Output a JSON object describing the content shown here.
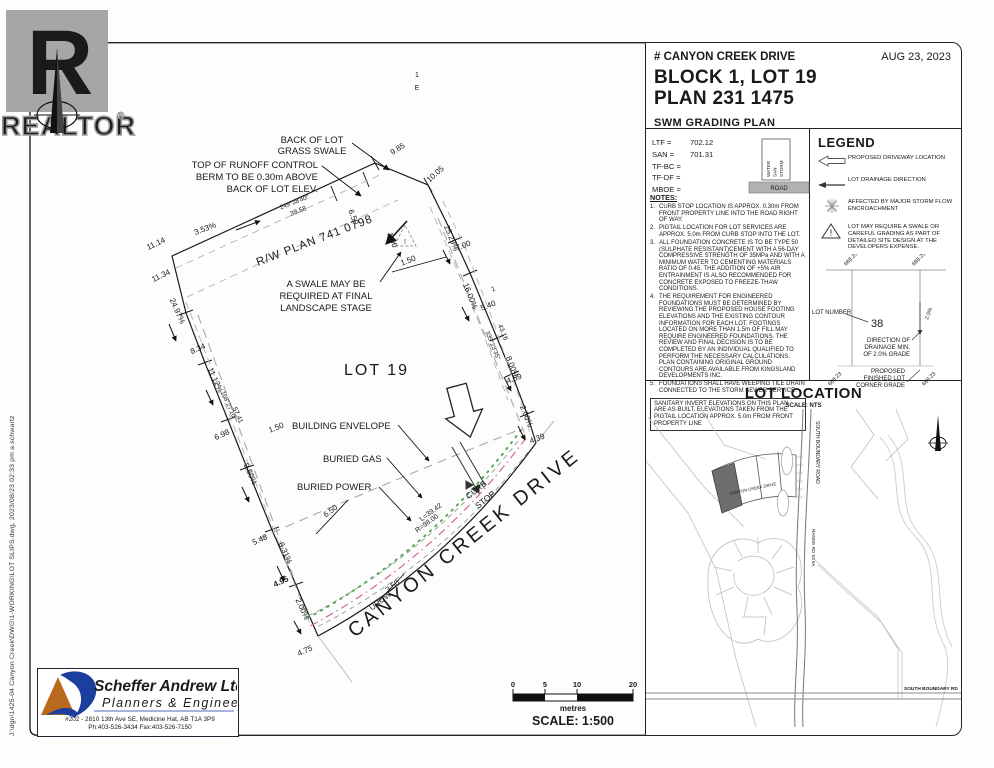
{
  "watermark": {
    "letter": "R",
    "brand": "REALTOR",
    "reg": "®"
  },
  "file_stamp": "J:\\dgn\\1425-04  Canyon Creek\\DWG\\1-WORKING\\LOT SLIPS.dwg,  2023/08/23 02:33 pm  a.schwartz",
  "title_block": {
    "street": "# CANYON CREEK DRIVE",
    "date": "AUG 23, 2023",
    "block_lot": "BLOCK 1, LOT 19",
    "plan": "PLAN 231 1475",
    "plan_type": "SWM GRADING PLAN",
    "elevations": [
      {
        "label": "LTF =",
        "value": "702.12"
      },
      {
        "label": "SAN =",
        "value": "701.31"
      },
      {
        "label": "TF-BC =",
        "value": ""
      },
      {
        "label": "TF-DF =",
        "value": ""
      },
      {
        "label": "MBOE =",
        "value": ""
      }
    ],
    "road_symbol": {
      "services": [
        "WATER",
        "SAN",
        "STORM"
      ],
      "road": "ROAD"
    }
  },
  "legend": {
    "title": "LEGEND",
    "items": [
      {
        "icon": "driveway-arrow",
        "label": "PROPOSED DRIVEWAY LOCATION"
      },
      {
        "icon": "drainage-arrow",
        "label": "LOT DRAINAGE DIRECTION"
      },
      {
        "icon": "storm-star",
        "label": "AFFECTED BY MAJOR STORM FLOW ENCROACHMENT"
      },
      {
        "icon": "warning-triangle",
        "label": "LOT MAY REQUIRE A SWALE OR CAREFUL GRADING AS PART OF DETAILED SITE DESIGN AT THE DEVELOPERS EXPENSE."
      }
    ],
    "sample": {
      "corner_top_left": "688.25",
      "corner_top_right": "688.25",
      "lot_number_label": "LOT NUMBER",
      "lot_number": "38",
      "grade": "2.0%",
      "drainage_label": [
        "DIRECTION OF",
        "DRAINAGE MIN.",
        "OF 2.0% GRADE"
      ],
      "corner_label": [
        "PROPOSED",
        "FINISHED LOT",
        "CORNER GRADE"
      ],
      "corner_bottom_left": "688.23",
      "corner_bottom_right": "688.23"
    }
  },
  "notes": {
    "heading": "NOTES:",
    "items": [
      "CURB STOP LOCATION IS APPROX. 0.30m FROM FRONT PROPERTY LINE INTO THE ROAD RIGHT OF WAY.",
      "PIGTAIL LOCATION FOR LOT SERVICES ARE APPROX. 5.0m FROM CURB STOP INTO THE LOT.",
      "ALL FOUNDATION CONCRETE IS TO BE TYPE 50 (SULPHATE RESISTANT)CEMENT WITH A 56-DAY COMPRESSIVE STRENGTH OF 35MPa AND WITH A MINIMUM WATER TO CEMENTING MATERIALS RATIO OF 0.45. THE ADDITION OF +5% AIR ENTRAINMENT IS ALSO RECOMMENDED FOR CONCRETE EXPOSED TO FREEZE-THAW CONDITIONS.",
      "THE REQUIREMENT FOR ENGINEERED FOUNDATIONS MUST BE DETERMINED BY REVIEWING THE PROPOSED HOUSE FOOTING ELEVATIONS AND THE EXISTING CONTOUR INFORMATION FOR EACH LOT. FOOTINGS LOCATED ON MORE THAN 1.5m OF FILL MAY REQUIRE ENGINEERED FOUNDATIONS. THE REVIEW AND FINAL DECISION IS TO BE COMPLETED BY AN INDIVIDUAL QUALIFIED TO PERFORM THE NECESSARY CALCULATIONS. PLAN CONTAINING ORIGINAL GROUND CONTOURS ARE AVAILABLE FROM KINGSLAND DEVELOPMENTS INC.",
      "FOUNDATIONS SHALL HAVE WEEPING TILE DRAIN CONNECTED TO THE STORM SEWER SERVICE."
    ],
    "boxed": "SANITARY INVERT ELEVATIONS ON THIS PLAN ARE AS-BUILT. ELEVATIONS TAKEN FROM THE PIGTAIL LOCATION APPROX. 5.0m FROM FRONT PROPERTY LINE"
  },
  "lot_location": {
    "title": "LOT LOCATION",
    "scale": "SCALE: NTS",
    "road_vertical": "SOUTH BOUNDARY ROAD",
    "range_road": "RANGE RD 53 5A",
    "street_curved": "CANYON CREEK DRIVE",
    "road_bottom": "SOUTH BOUNDARY RD"
  },
  "plan": {
    "lot_label": "LOT 19",
    "street": "CANYON CREEK DRIVE",
    "rw_plan": "R/W PLAN 741 0798",
    "callouts": {
      "back_of_lot": [
        "BACK OF LOT",
        "GRASS SWALE"
      ],
      "berm": [
        "TOP OF RUNOFF CONTROL",
        "BERM TO BE 0.30m ABOVE",
        "BACK OF LOT ELEV."
      ],
      "swale": [
        "A SWALE MAY BE",
        "REQUIRED AT FINAL",
        "LANDSCAPE STAGE"
      ],
      "building_envelope": "BUILDING ENVELOPE",
      "buried_gas": "BURIED GAS",
      "buried_power": "BURIED POWER"
    },
    "dims": [
      {
        "t": "9.85",
        "x": 399,
        "y": 151,
        "r": -33
      },
      {
        "t": "10.05",
        "x": 437,
        "y": 176,
        "r": -42
      },
      {
        "t": "249°38'40\"",
        "x": 295,
        "y": 204,
        "r": -21,
        "s": 6.3
      },
      {
        "t": "38.58",
        "x": 299,
        "y": 213,
        "r": -21,
        "s": 6.8
      },
      {
        "t": "3.53%",
        "x": 206,
        "y": 231,
        "r": -21
      },
      {
        "t": "6.50",
        "x": 351,
        "y": 218,
        "r": 68
      },
      {
        "t": "1.00",
        "x": 390,
        "y": 241,
        "r": 68
      },
      {
        "t": "25.29%",
        "x": 449,
        "y": 239,
        "r": 68
      },
      {
        "t": "7.00",
        "x": 464,
        "y": 248,
        "r": -21
      },
      {
        "t": "1.50",
        "x": 409,
        "y": 263,
        "r": -21
      },
      {
        "t": "16.00%",
        "x": 468,
        "y": 297,
        "r": 68
      },
      {
        "t": "1",
        "x": 494,
        "y": 291,
        "r": -21,
        "s": 6.8
      },
      {
        "t": "5.40",
        "x": 489,
        "y": 308,
        "r": -21
      },
      {
        "t": "339°23'35\"",
        "x": 491,
        "y": 346,
        "r": 68,
        "s": 6.3
      },
      {
        "t": "43.16",
        "x": 501,
        "y": 333,
        "r": 68,
        "s": 6.8
      },
      {
        "t": "8.00%",
        "x": 510,
        "y": 368,
        "r": 68
      },
      {
        "t": "4.59",
        "x": 515,
        "y": 381,
        "r": -21
      },
      {
        "t": "2.00%",
        "x": 524,
        "y": 417,
        "r": 68
      },
      {
        "t": "4.39",
        "x": 538,
        "y": 441,
        "r": -21
      },
      {
        "t": "11.14",
        "x": 157,
        "y": 246,
        "r": -25
      },
      {
        "t": "11.34",
        "x": 162,
        "y": 278,
        "r": -25
      },
      {
        "t": "24.97%",
        "x": 175,
        "y": 312,
        "r": 66
      },
      {
        "t": "8.34",
        "x": 199,
        "y": 351,
        "r": -25
      },
      {
        "t": "11.12%",
        "x": 213,
        "y": 381,
        "r": 66
      },
      {
        "t": "168°27'10\"",
        "x": 227,
        "y": 406,
        "r": 66,
        "s": 6.3
      },
      {
        "t": "57.41",
        "x": 236,
        "y": 416,
        "r": 66,
        "s": 6.8
      },
      {
        "t": "6.98",
        "x": 223,
        "y": 437,
        "r": -25
      },
      {
        "t": "1.50",
        "x": 277,
        "y": 430,
        "r": -21
      },
      {
        "t": "9.50%",
        "x": 248,
        "y": 475,
        "r": 66
      },
      {
        "t": "5.48",
        "x": 261,
        "y": 542,
        "r": -25
      },
      {
        "t": "8.31%",
        "x": 283,
        "y": 554,
        "r": 66
      },
      {
        "t": "4.95",
        "x": 282,
        "y": 584,
        "r": -25,
        "w": "bold"
      },
      {
        "t": "2.00%",
        "x": 300,
        "y": 610,
        "r": 66
      },
      {
        "t": "4.75",
        "x": 306,
        "y": 653,
        "r": -25
      },
      {
        "t": "6.50",
        "x": 332,
        "y": 513,
        "r": -38
      },
      {
        "t": "3.50",
        "x": 394,
        "y": 588,
        "r": -38
      },
      {
        "t": "UROW",
        "x": 382,
        "y": 603,
        "r": -38
      },
      {
        "t": "L=39.42",
        "x": 432,
        "y": 514,
        "r": -36,
        "s": 7
      },
      {
        "t": "R=98.00",
        "x": 428,
        "y": 525,
        "r": -36,
        "s": 7
      },
      {
        "t": "CURB",
        "x": 478,
        "y": 492,
        "r": -38,
        "s": 8.5
      },
      {
        "t": "STOP",
        "x": 487,
        "y": 502,
        "r": -38,
        "s": 8.5
      },
      {
        "t": "1",
        "x": 417,
        "y": 77,
        "r": 0,
        "s": 7,
        "c": "#888"
      },
      {
        "t": "E",
        "x": 417,
        "y": 90,
        "r": 0,
        "s": 7,
        "c": "#888"
      }
    ],
    "scalebar": {
      "ticks": [
        "0",
        "5",
        "10",
        "20"
      ],
      "unit": "metres",
      "scale": "SCALE: 1:500"
    }
  },
  "firm": {
    "name": "Scheffer Andrew Ltd.",
    "tagline": "Planners & Engineers",
    "address": "#202 - 2810 13th Ave SE, Medicine Hat, AB  T1A 3P9",
    "phone": "Ph:403-526-3434     Fax:403-526-7150"
  }
}
